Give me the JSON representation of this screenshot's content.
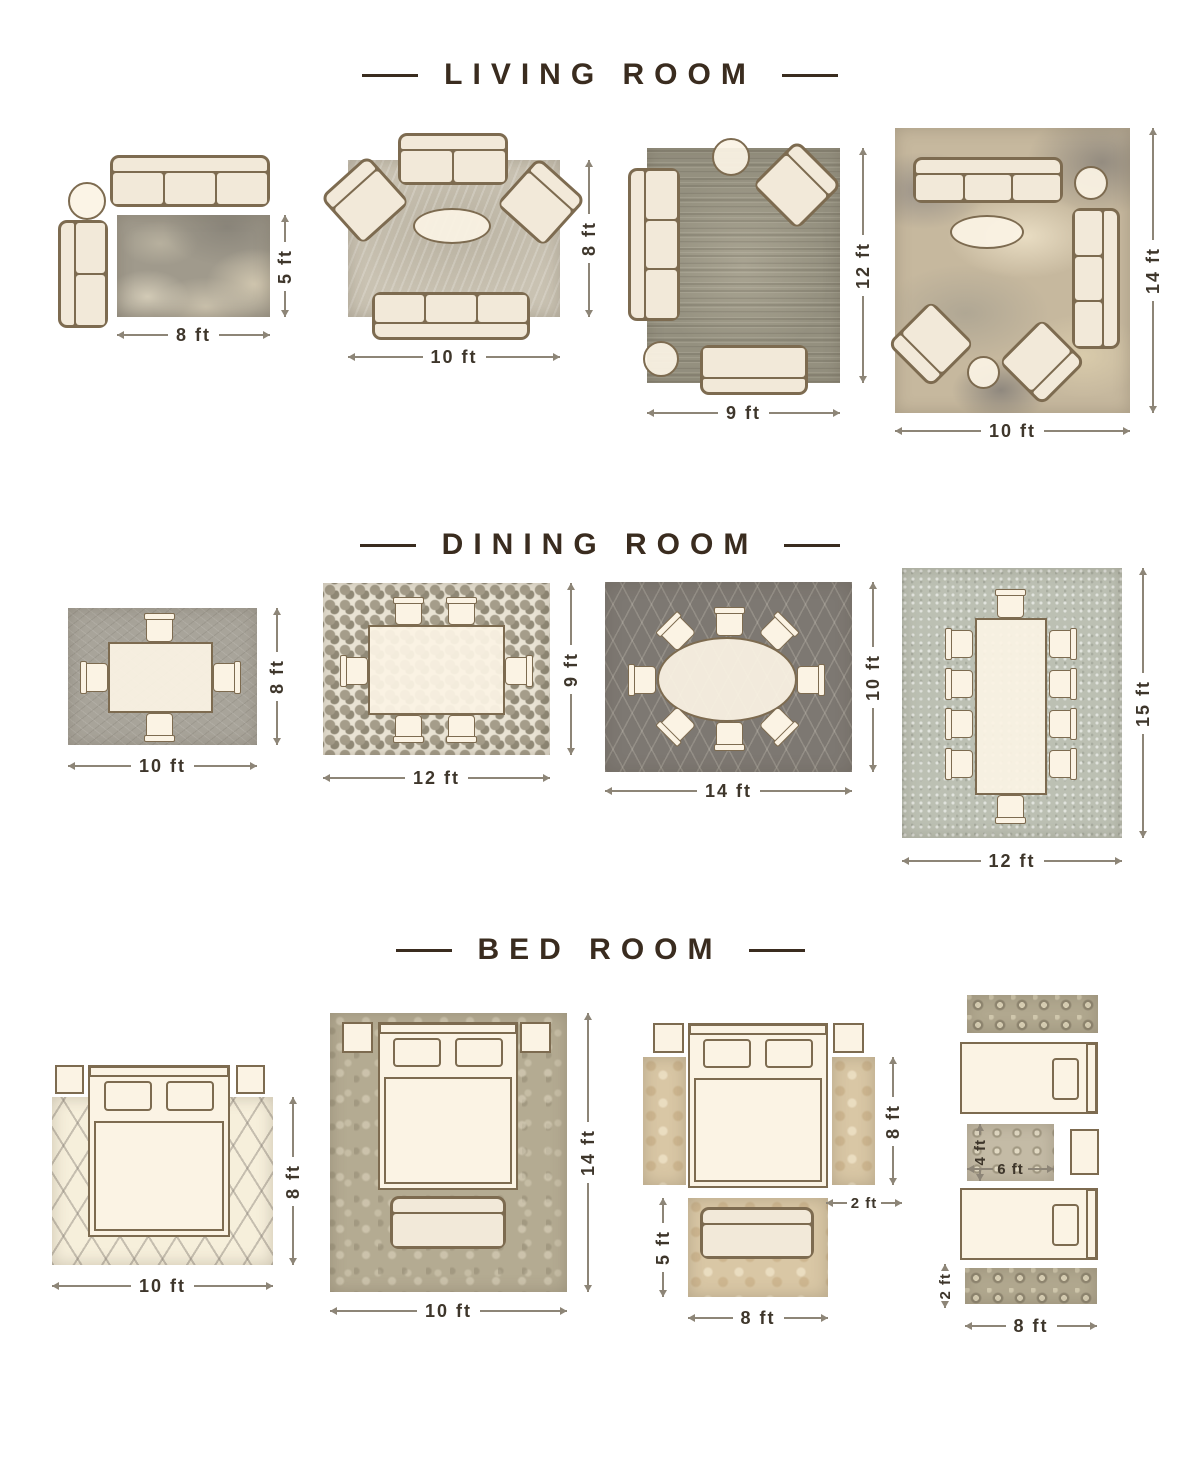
{
  "colors": {
    "background": "#ffffff",
    "title_text": "#3a2c1f",
    "furniture_fill": "#fbf3e4",
    "furniture_outline": "#7d6b50",
    "dimension_text": "#3e362b",
    "dimension_line": "#8d8577"
  },
  "sections": [
    {
      "title": "LIVING ROOM",
      "layouts": [
        {
          "rug": "distressed gray rug",
          "rug_size": "8 x 5 ft",
          "width_label": "8 ft",
          "height_label": "5 ft",
          "furniture": [
            "three-seat-sofa",
            "round-side-table",
            "two-seat-sofa"
          ]
        },
        {
          "rug": "light taupe rug",
          "rug_size": "10 x 8 ft",
          "width_label": "10 ft",
          "height_label": "8 ft",
          "furniture": [
            "loveseat",
            "armchair",
            "armchair",
            "oval-coffee-table",
            "three-seat-sofa"
          ]
        },
        {
          "rug": "distressed gray-olive rug",
          "rug_size": "9 x 12 ft",
          "width_label": "9 ft",
          "height_label": "12 ft",
          "furniture": [
            "round-side-table",
            "armchair",
            "three-seat-sofa",
            "round-side-table",
            "loveseat"
          ]
        },
        {
          "rug": "abstract beige-gray rug",
          "rug_size": "10 x 14 ft",
          "width_label": "10 ft",
          "height_label": "14 ft",
          "furniture": [
            "three-seat-sofa",
            "round-side-table",
            "oval-coffee-table",
            "three-seat-sofa",
            "armchair",
            "armchair",
            "round-side-table"
          ]
        }
      ]
    },
    {
      "title": "DINING ROOM",
      "layouts": [
        {
          "rug": "gray textured rug",
          "rug_size": "10 x 8 ft",
          "width_label": "10 ft",
          "height_label": "8 ft",
          "furniture": [
            "dining-table",
            "dining-chair x4"
          ]
        },
        {
          "rug": "pebble mosaic rug",
          "rug_size": "12 x 9 ft",
          "width_label": "12 ft",
          "height_label": "9 ft",
          "furniture": [
            "dining-table",
            "dining-chair x6"
          ]
        },
        {
          "rug": "dark gray trellis rug",
          "rug_size": "14 x 10 ft",
          "width_label": "14 ft",
          "height_label": "10 ft",
          "furniture": [
            "oval-dining-table",
            "dining-chair x8"
          ]
        },
        {
          "rug": "light gray-sage rug",
          "rug_size": "12 x 15 ft",
          "width_label": "12 ft",
          "height_label": "15 ft",
          "furniture": [
            "long-dining-table",
            "dining-chair x10"
          ]
        }
      ]
    },
    {
      "title": "BED ROOM",
      "layouts": [
        {
          "rug": "cream trellis rug",
          "rug_size": "10 x 8 ft",
          "width_label": "10 ft",
          "height_label": "8 ft",
          "furniture": [
            "queen-bed",
            "nightstand",
            "nightstand"
          ]
        },
        {
          "rug": "sage damask rug",
          "rug_size": "10 x 14 ft",
          "width_label": "10 ft",
          "height_label": "14 ft",
          "furniture": [
            "queen-bed",
            "nightstand",
            "nightstand",
            "bench"
          ]
        },
        {
          "rug": "tan floral runners and foot rug",
          "runner_size": "2 x 8 ft",
          "foot_rug_size": "8 x 5 ft",
          "runner_height_label": "8 ft",
          "runner_width_label": "2 ft",
          "foot_rug_height_label": "5 ft",
          "foot_rug_width_label": "8 ft",
          "furniture": [
            "queen-bed",
            "nightstand",
            "nightstand",
            "runner-rug",
            "runner-rug",
            "bench"
          ]
        },
        {
          "rug": "ornate runners and between-beds rug",
          "runner_size": "8 x 2 ft",
          "between_rug_size": "6 x 4 ft",
          "between_rug_height_label": "4 ft",
          "between_rug_width_label": "6 ft",
          "runner_height_label": "2 ft",
          "runner_width_label": "8 ft",
          "furniture": [
            "twin-bed",
            "twin-bed",
            "nightstand",
            "runner-rug",
            "runner-rug",
            "between-beds-rug"
          ]
        }
      ]
    }
  ]
}
